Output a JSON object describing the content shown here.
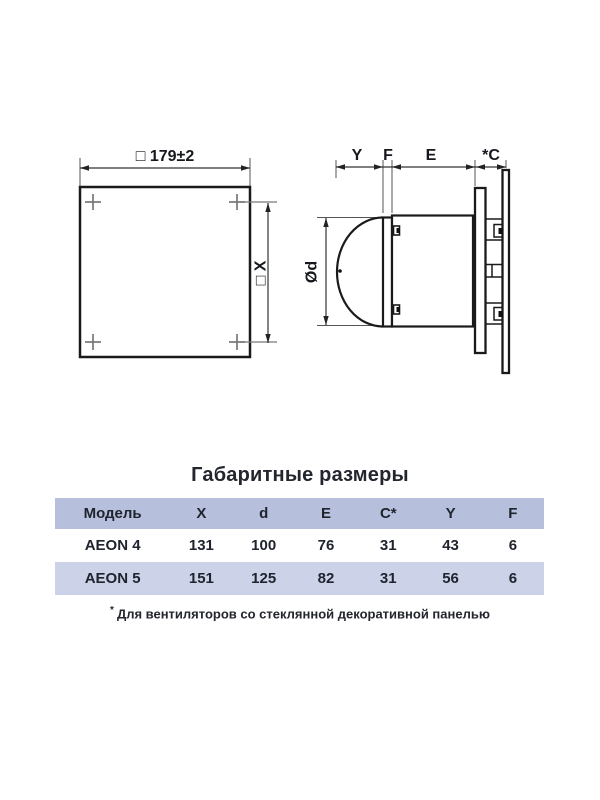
{
  "diagram": {
    "front_view": {
      "width_dim_label": "□ 179±2",
      "hole_spacing_dim_label": "□ X"
    },
    "side_view": {
      "dim_labels": {
        "y": "Y",
        "f": "F",
        "e": "E",
        "c": "*C"
      },
      "diameter_label": "Ød"
    }
  },
  "dimensions_table": {
    "title": "Габаритные размеры",
    "headers": [
      "Модель",
      "X",
      "d",
      "E",
      "C*",
      "Y",
      "F"
    ],
    "rows": [
      [
        "AEON 4",
        "131",
        "100",
        "76",
        "31",
        "43",
        "6"
      ],
      [
        "AEON 5",
        "151",
        "125",
        "82",
        "31",
        "56",
        "6"
      ]
    ]
  },
  "footnote": {
    "marker": "*",
    "text": "Для вентиляторов со стеклянной декоративной панелью"
  },
  "colors": {
    "table_header_bg": "#b6c0dc",
    "table_row_alt_bg": "#ccd3e8",
    "table_text": "#20242e",
    "outline": "#1a1a1a",
    "thin_line": "#555555",
    "marker_gray": "#777777"
  }
}
